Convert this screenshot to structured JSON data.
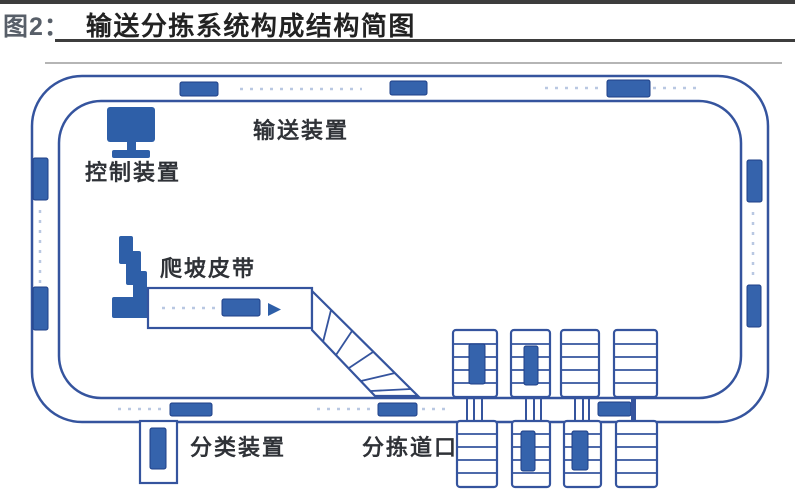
{
  "header": {
    "figure_label": "图2：",
    "title": "输送分拣系统构成结构简图"
  },
  "diagram": {
    "labels": {
      "control_device": "控制装置",
      "conveyor_device": "输送装置",
      "climb_belt": "爬坡皮带",
      "classify_device": "分类装置",
      "sorting_gate": "分拣道口"
    }
  },
  "colors": {
    "parcel_fill": "#3563ac",
    "parcel_stroke": "#1e3f87",
    "line_blue": "#35549e",
    "dash_blue": "#b9c8e2",
    "icon_blue": "#2e5fa8",
    "title_color": "#222222",
    "figure_label_color": "#585f69",
    "label_color": "#2f3237",
    "rule_dark": "#3d3d3d",
    "faint_rule": "#b5b5b5"
  }
}
